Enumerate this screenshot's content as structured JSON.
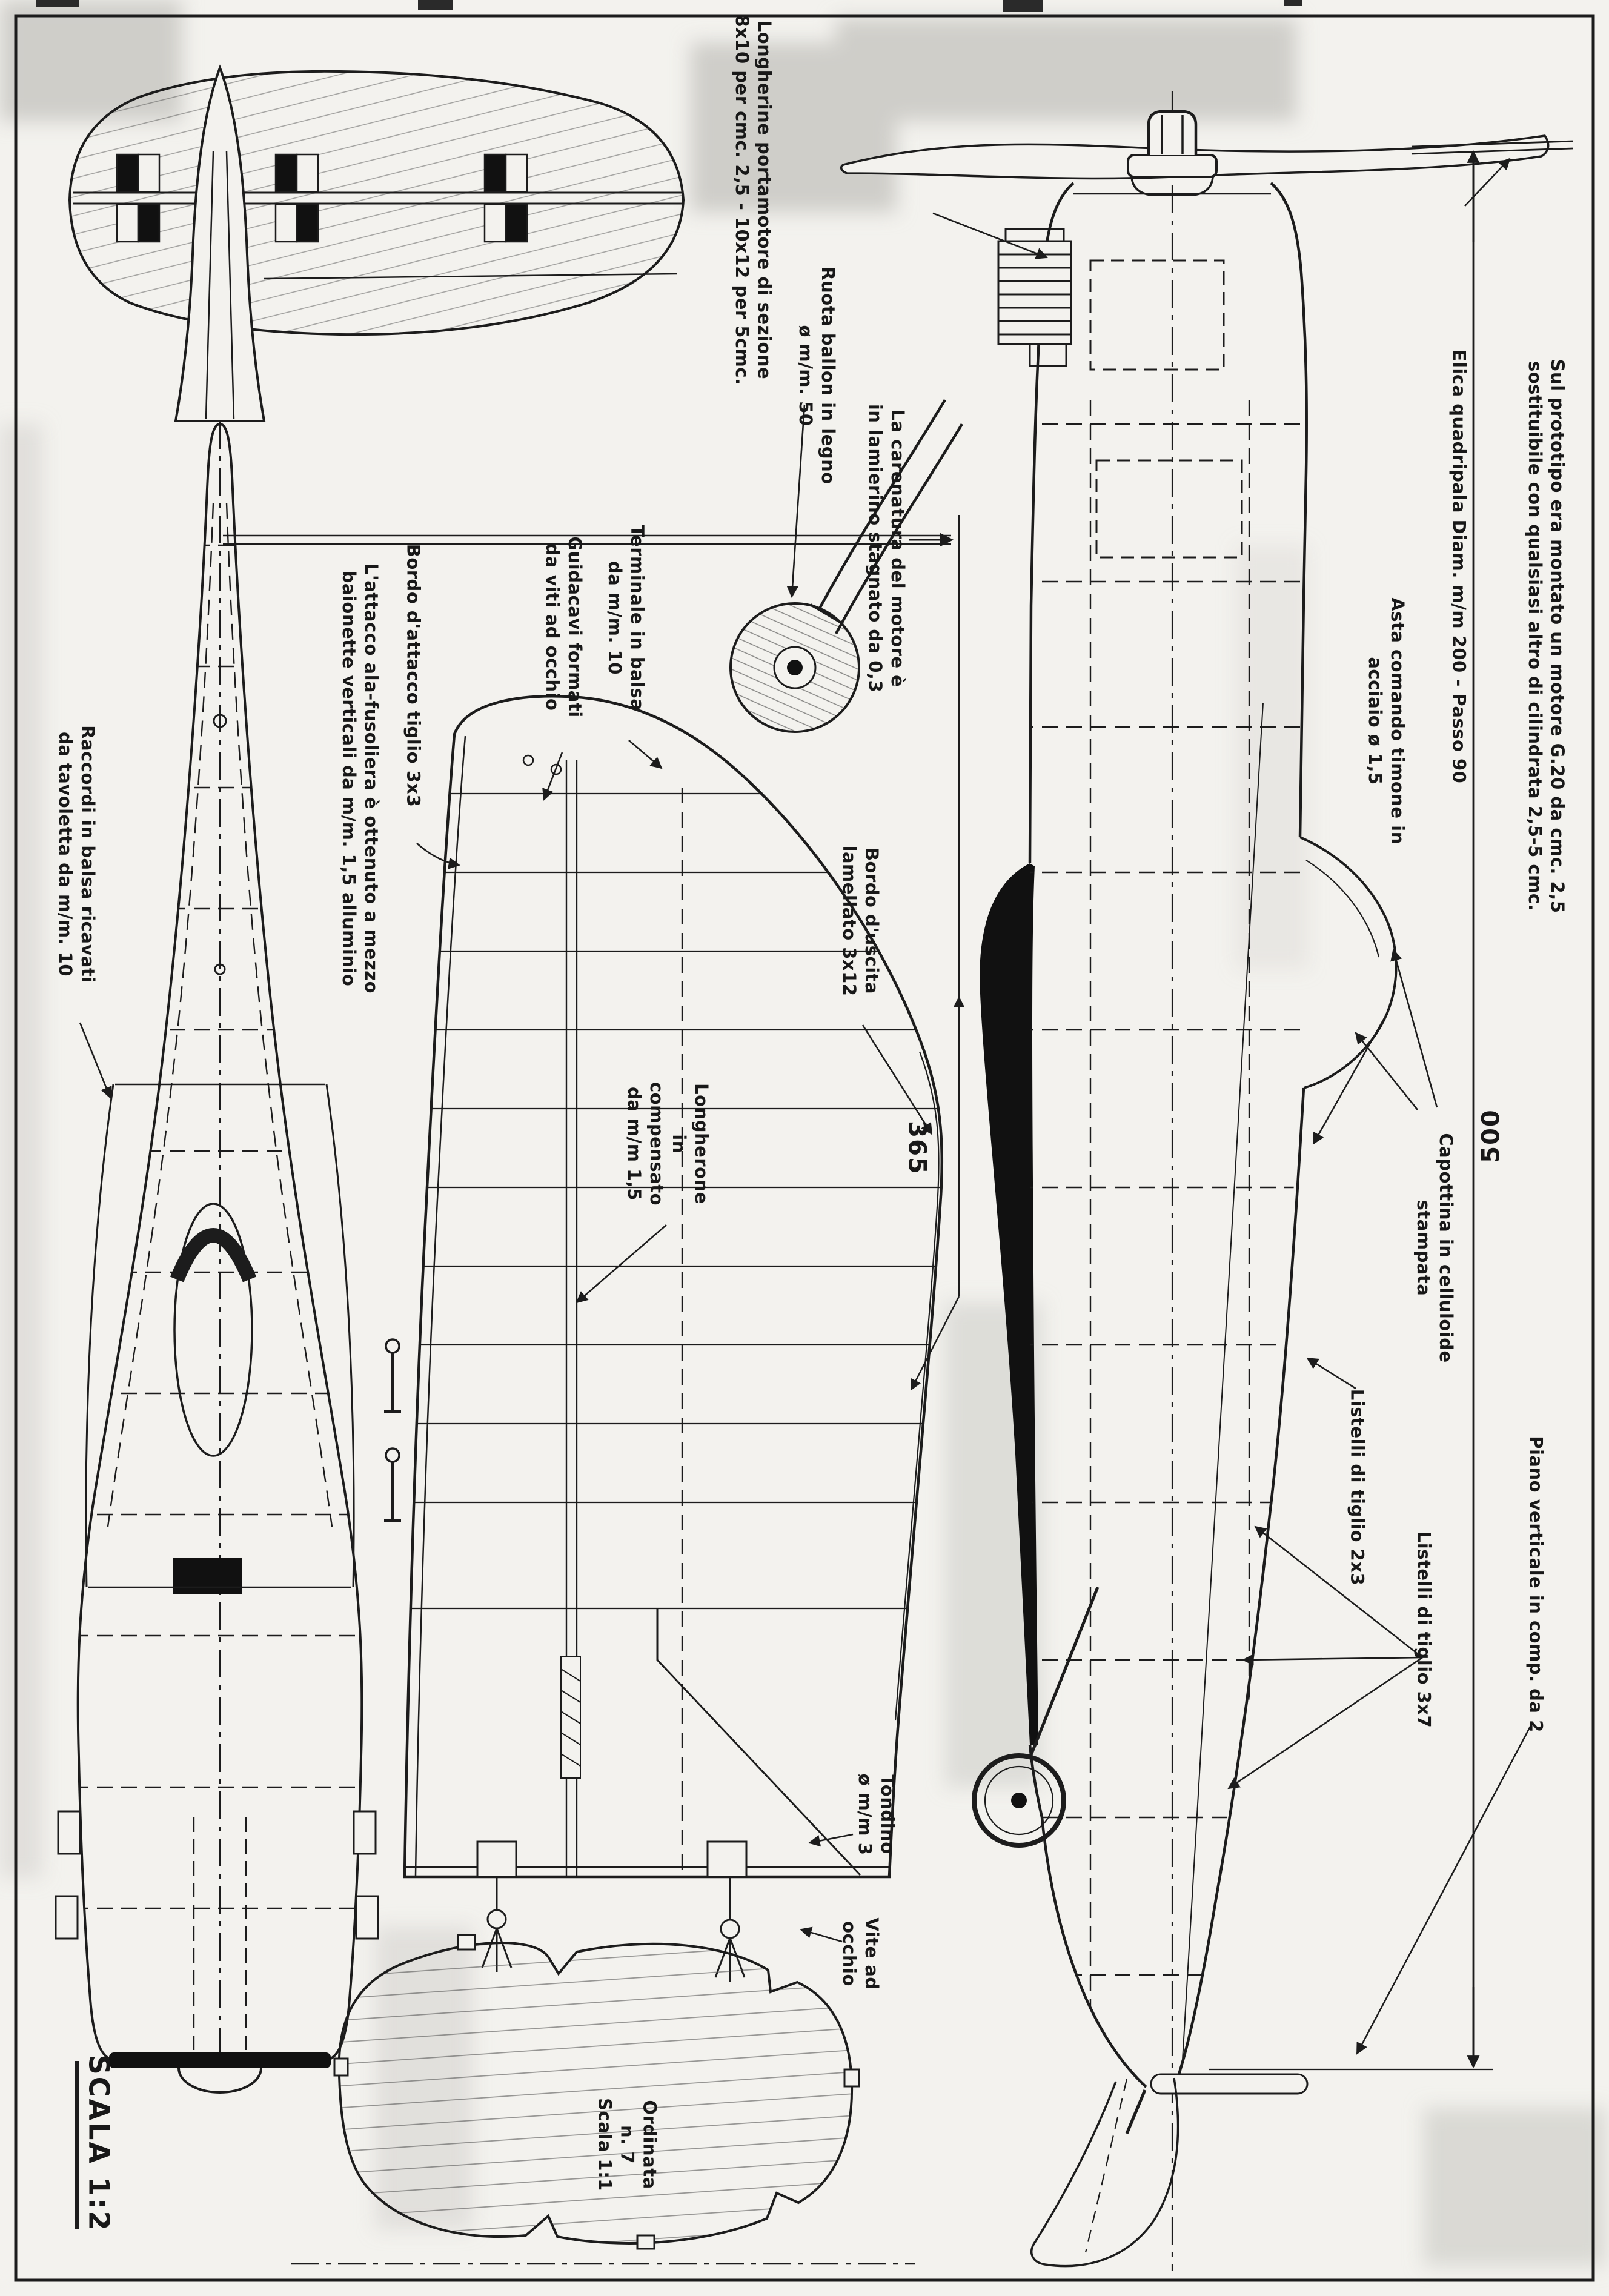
{
  "document": {
    "kind": "model aircraft construction plan (scanned blueprint, Italian)",
    "sheet_scale": "SCALA 1:2",
    "template_scale": "Scala 1:1"
  },
  "colors": {
    "ink": "#1c1c1c",
    "paper": "#f3f2ee",
    "fill_black": "#111111"
  },
  "dimensions": {
    "wing_chord": "365",
    "overall_length": "500"
  },
  "labels": {
    "motor_note": {
      "lines": [
        "Sul prototipo era montato un motore G.20 da cmc. 2,5",
        "sostituibile con qualsiasi altro di cilindrata 2,5-5 cmc."
      ]
    },
    "elica": {
      "lines": [
        "Elica quadripala  Diam. m/m 200 - Passo 90"
      ]
    },
    "asta": {
      "lines": [
        "Asta comando timone in",
        "acciaio ø 1,5"
      ]
    },
    "carenatura": {
      "lines": [
        "La carenatura del motore è",
        "in lamierino stagnato da 0,3"
      ]
    },
    "ruota": {
      "lines": [
        "Ruota ballon in legno",
        "ø m/m. 50"
      ]
    },
    "longherine": {
      "lines": [
        "Longherine portamotore di sezione",
        "8x10 per cmc. 2,5 - 10x12 per 5cmc."
      ]
    },
    "terminale": {
      "lines": [
        "Terminale in balsa",
        "da m/m. 10"
      ]
    },
    "guidacavi": {
      "lines": [
        "Guidacavi formati",
        "da viti ad occhio"
      ]
    },
    "bordo_attacco": {
      "lines": [
        "Bordo d'attacco tiglio 3x3"
      ]
    },
    "attacco_ala": {
      "lines": [
        "L'attacco ala-fusoliera è ottenuto a mezzo",
        "baionette verticali da m/m. 1,5 alluminio"
      ]
    },
    "raccordi": {
      "lines": [
        "Raccordi in balsa ricavati",
        "da tavoletta da m/m. 10"
      ]
    },
    "bordo_uscita": {
      "lines": [
        "Bordo d'uscita",
        "lamellato 3x12"
      ]
    },
    "longherone": {
      "lines": [
        "Longherone",
        "in",
        "compensato",
        "da m/m 1,5"
      ]
    },
    "capottina": {
      "lines": [
        "Capottina in celluloide",
        "stampata"
      ]
    },
    "listelli_2x3": {
      "lines": [
        "Listelli di  tiglio 2x3"
      ]
    },
    "listelli_3x7": {
      "lines": [
        "Listelli di tiglio 3x7"
      ]
    },
    "piano_verticale": {
      "lines": [
        "Piano verticale in comp. da 2"
      ]
    },
    "tondino": {
      "lines": [
        "Tondino",
        "ø m/m 3"
      ]
    },
    "vite": {
      "lines": [
        "Vite ad",
        "occhio"
      ]
    },
    "ordinata": {
      "lines": [
        "Ordinata",
        "n. 7",
        "Scala 1:1"
      ]
    },
    "scala_sheet": {
      "lines": [
        "SCALA 1:2"
      ]
    }
  }
}
